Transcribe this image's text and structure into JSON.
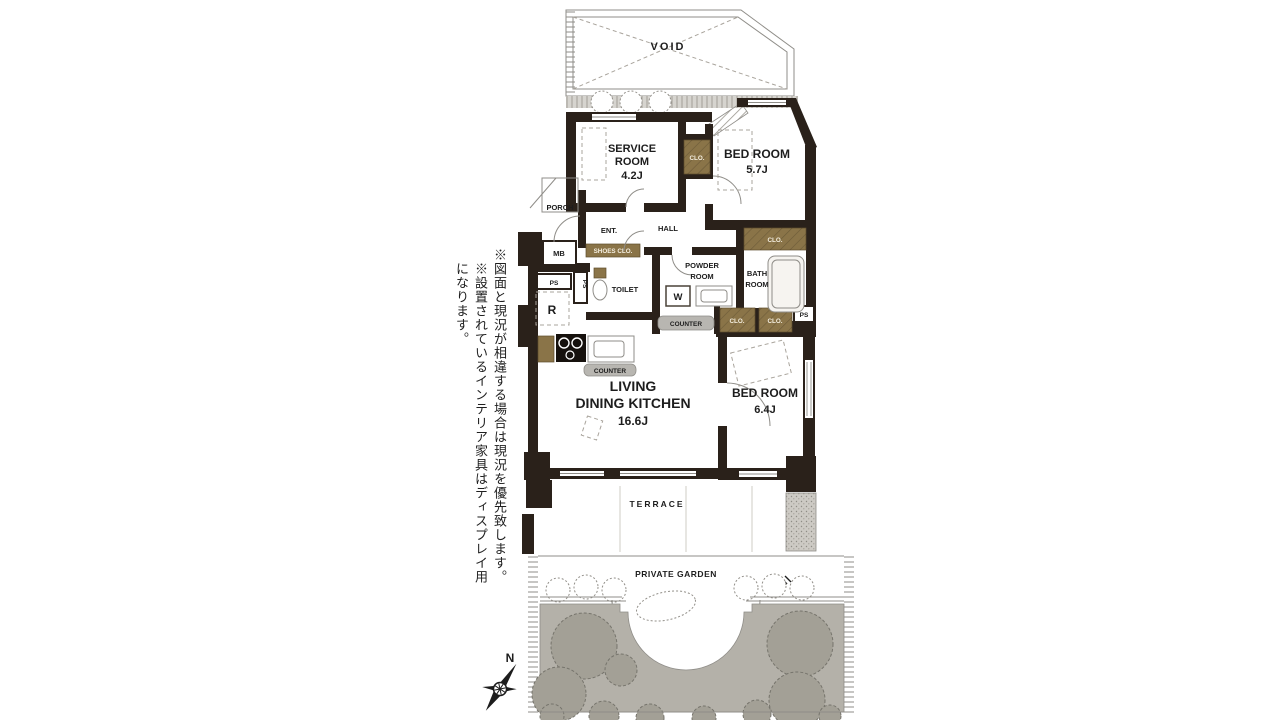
{
  "notes": {
    "note1": "※図面と現況が相違する場合は現況を優先致します。",
    "note2": "※設置されているインテリア家具はディスプレイ用になります。"
  },
  "compass": {
    "north": "N"
  },
  "plan": {
    "void_label": "VOID",
    "service_room": {
      "name_line1": "SERVICE",
      "name_line2": "ROOM",
      "size": "4.2J"
    },
    "bed_room_57": {
      "name": "BED ROOM",
      "size": "5.7J"
    },
    "bed_room_64": {
      "name": "BED ROOM",
      "size": "6.4J"
    },
    "ldk": {
      "name_line1": "LIVING",
      "name_line2": "DINING KITCHEN",
      "size": "16.6J"
    },
    "powder_room": {
      "line1": "POWDER",
      "line2": "ROOM"
    },
    "bath_room": {
      "line1": "BATH",
      "line2": "ROOM"
    },
    "labels": {
      "terrace": "TERRACE",
      "private_garden": "PRIVATE GARDEN",
      "porch": "PORCH",
      "ent": "ENT.",
      "hall": "HALL",
      "mb": "MB",
      "shoes_clo": "SHOES CLO.",
      "toilet": "TOILET",
      "washer": "W",
      "refrigerator": "R",
      "ps": "PS",
      "counter": "COUNTER",
      "clo": "CLO."
    },
    "colors": {
      "wall": "#2a211a",
      "closet": "#8a7448",
      "counter": "#b8b6b1",
      "garden": "#b4b1a9",
      "tree": "#a3a096"
    }
  }
}
